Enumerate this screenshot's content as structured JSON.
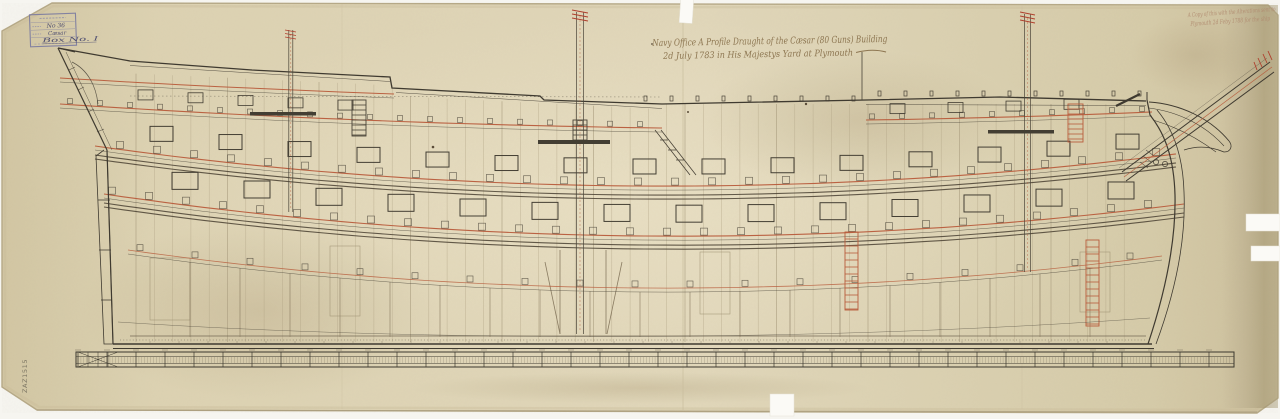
{
  "document": {
    "title_line1": "Navy Office   A Profile Draught of the Cæsar (80 Guns) Building",
    "title_line2": "2d July 1783 in His Majestys Yard at Plymouth",
    "annotation_line1": "A Copy of this with the Alterations sent to",
    "annotation_line2": "Plymouth 2d Feby 1788 for the ship",
    "reference_number": "ZAZ1515",
    "stamp": {
      "registry_number": "No 36",
      "ship_name": "Cæsar",
      "box_number": "Box No. I"
    },
    "colors": {
      "paper": "#ddd2b2",
      "ink": "#3f3a30",
      "deck_ink_red": "#b85c3c",
      "stamp_ink": "#686892",
      "pencil": "#8a8270"
    }
  }
}
